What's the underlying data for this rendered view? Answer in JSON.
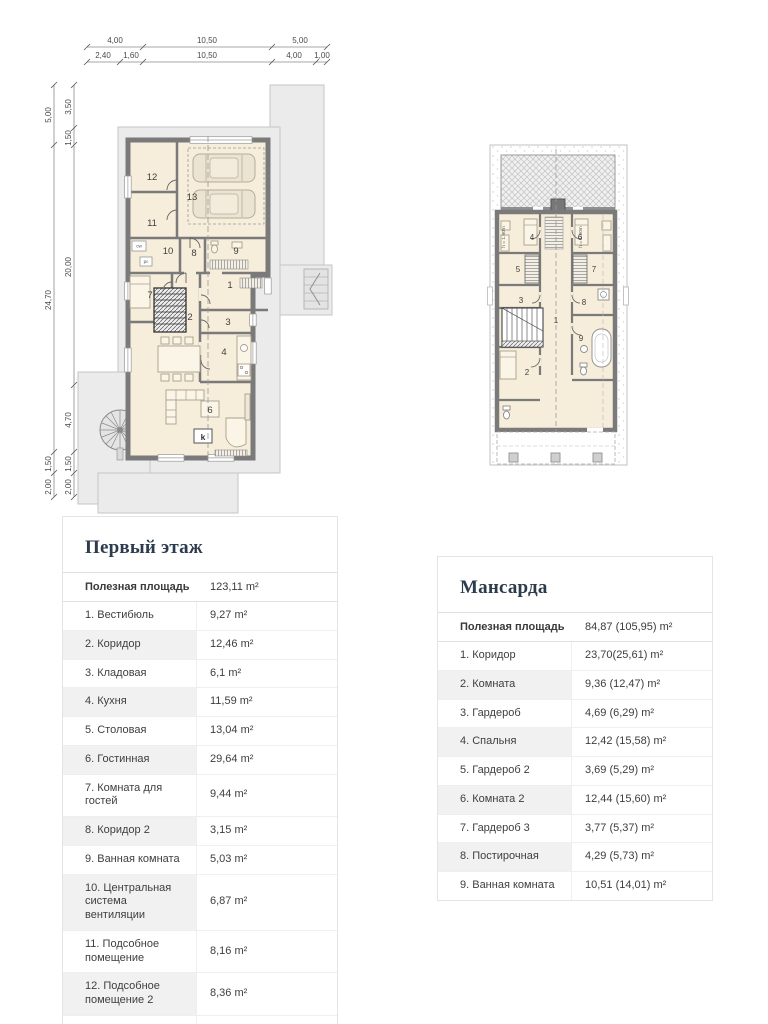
{
  "colors": {
    "title_accent": "#2c3b4d",
    "plan_wall": "#7a7a7a",
    "plan_room_fill": "#f6edda",
    "plan_paving": "#ebebeb",
    "table_alt_row": "#f1f1f1",
    "table_border": "#e4e4e4"
  },
  "plans": {
    "first_floor": {
      "dims_top_row1": [
        "4,00",
        "10,50",
        "5,00"
      ],
      "dims_top_row2": [
        "2,40",
        "1,60",
        "10,50",
        "4,00",
        "1,00"
      ],
      "dims_left_outer": [
        "5,00",
        "24,70",
        "1,50",
        "2,00"
      ],
      "dims_left_inner": [
        "3,50",
        "1,50",
        "20,00",
        "4,70",
        "1,50",
        "2,00"
      ],
      "room_labels": {
        "r1": "1",
        "r2": "2",
        "r3": "3",
        "r4": "4",
        "r6": "6",
        "r7": "7",
        "r8": "8",
        "r9": "9",
        "r10": "10",
        "r11": "11",
        "r12": "12",
        "r13": "13"
      },
      "boiler_label": "k",
      "appliance_labels": [
        "cw",
        "pc"
      ]
    },
    "attic": {
      "room_labels": {
        "r1": "1",
        "r2": "2",
        "r3": "3",
        "r4": "4",
        "r5": "5",
        "r6": "6",
        "r7": "7",
        "r8": "8",
        "r9": "9"
      },
      "height_note": "h = 1.90m"
    }
  },
  "tables": {
    "first_floor": {
      "title": "Первый этаж",
      "summary_label": "Полезная площадь",
      "summary_value": "123,11 m²",
      "rows": [
        {
          "label": "1. Вестибюль",
          "value": "9,27 m²"
        },
        {
          "label": "2. Коридор",
          "value": "12,46 m²"
        },
        {
          "label": "3. Кладовая",
          "value": "6,1 m²"
        },
        {
          "label": "4. Кухня",
          "value": "11,59 m²"
        },
        {
          "label": "5. Столовая",
          "value": "13,04 m²"
        },
        {
          "label": "6. Гостинная",
          "value": "29,64 m²"
        },
        {
          "label": "7. Комната для гостей",
          "value": "9,44 m²"
        },
        {
          "label": "8. Коридор 2",
          "value": "3,15 m²"
        },
        {
          "label": "9. Ванная комната",
          "value": "5,03 m²"
        },
        {
          "label": "10. Центральная система вентиляции",
          "value": "6,87 m²"
        },
        {
          "label": "11. Подсобное помещение",
          "value": "8,16 m²"
        },
        {
          "label": "12. Подсобное помещение 2",
          "value": "8,36 m²"
        },
        {
          "label": "13. Гараж",
          "value": "48,89 m²"
        }
      ]
    },
    "attic": {
      "title": "Мансарда",
      "summary_label": "Полезная площадь",
      "summary_value": "84,87 (105,95) m²",
      "rows": [
        {
          "label": "1. Коридор",
          "value": "23,70(25,61) m²"
        },
        {
          "label": "2. Комната",
          "value": "9,36 (12,47) m²"
        },
        {
          "label": "3. Гардероб",
          "value": "4,69 (6,29) m²"
        },
        {
          "label": "4. Спальня",
          "value": "12,42 (15,58) m²"
        },
        {
          "label": "5. Гардероб 2",
          "value": "3,69 (5,29) m²"
        },
        {
          "label": "6. Комната 2",
          "value": "12,44 (15,60) m²"
        },
        {
          "label": "7. Гардероб 3",
          "value": "3,77 (5,37) m²"
        },
        {
          "label": "8. Постирочная",
          "value": "4,29 (5,73) m²"
        },
        {
          "label": "9. Ванная комната",
          "value": "10,51 (14,01) m²"
        }
      ]
    }
  }
}
